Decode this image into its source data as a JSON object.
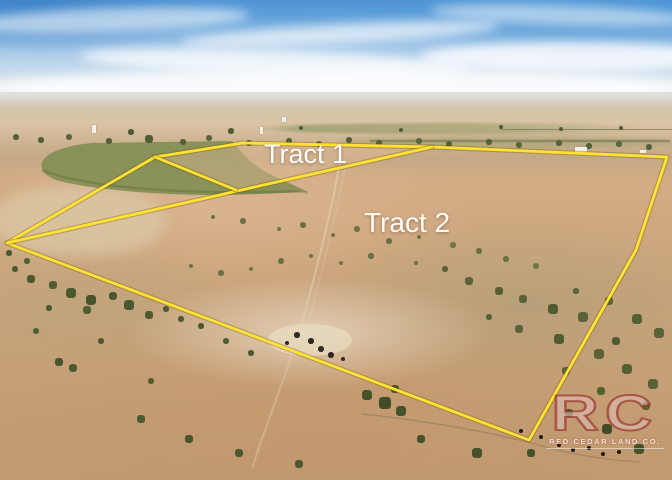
{
  "labels": {
    "tract1": "Tract 1",
    "tract2": "Tract 2"
  },
  "watermark": {
    "initials": "RC",
    "company": "RED CEDAR LAND CO."
  },
  "colors": {
    "boundary_yellow": "#FFE232",
    "boundary_shadow": "rgba(110,85,0,0.35)",
    "logo_maroon": "#96352C",
    "label_white": "#FFFFFF"
  },
  "overlay": {
    "shapes": [
      {
        "name": "outer-boundary",
        "points": "7,243 155,157 243,143 432,147 667,157 636,250 529,440 7,243"
      },
      {
        "name": "tract-divider",
        "points": "432,147 7,243"
      },
      {
        "name": "tract1-bottom-edge",
        "points": "155,157 236,190"
      }
    ]
  }
}
